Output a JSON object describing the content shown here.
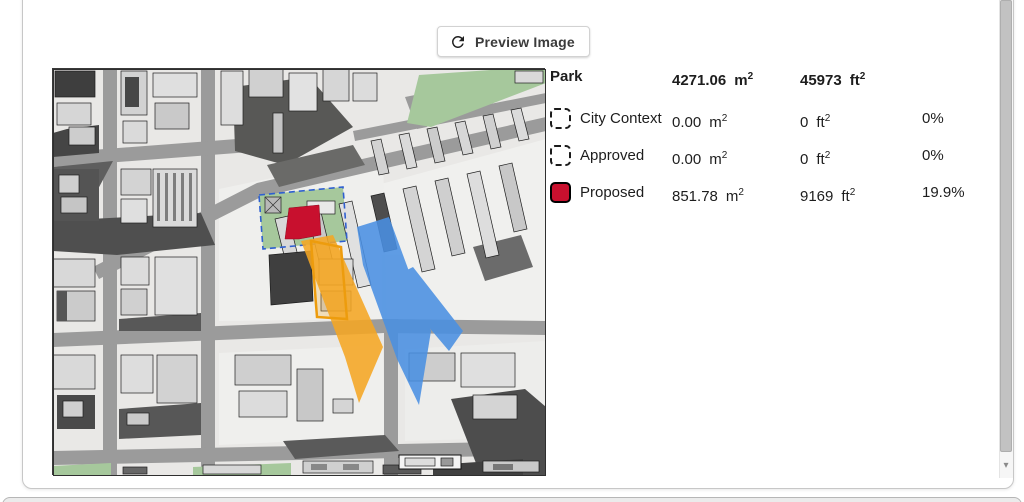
{
  "preview": {
    "button_label": "Preview Image"
  },
  "legend": {
    "units": {
      "m": "m",
      "ft": "ft",
      "sup": "2"
    },
    "header": {
      "label": "Park",
      "m_value": "4271.06",
      "ft_value": "45973"
    },
    "rows": [
      {
        "label": "City Context",
        "m_value": "0.00",
        "ft_value": "0",
        "percent": "0%",
        "swatch": "dashed-outline"
      },
      {
        "label": "Approved",
        "m_value": "0.00",
        "ft_value": "0",
        "percent": "0%",
        "swatch": "dashed-outline"
      },
      {
        "label": "Proposed",
        "m_value": "851.78",
        "ft_value": "9169",
        "percent": "19.9%",
        "swatch": "red-filled"
      }
    ]
  },
  "map": {
    "colors": {
      "proposed_red": "#C8102E",
      "overlay_orange": "#F5A623",
      "overlay_blue": "#4A90E2",
      "park_green": "#A6C89C",
      "street_gray": "#9B9B9B"
    }
  },
  "scrollbar": {
    "down_arrow": "▾"
  }
}
